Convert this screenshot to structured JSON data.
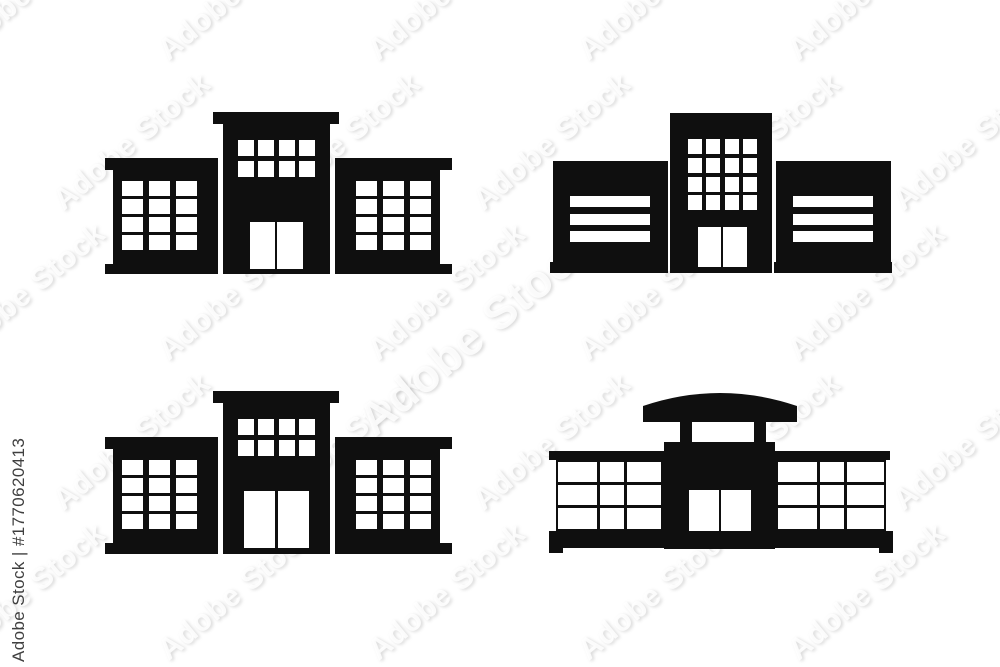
{
  "image": {
    "background": "#ffffff",
    "icon_color": "#0f0f0f",
    "window_color": "#ffffff"
  },
  "watermark": {
    "tile_text": "Adobe Stock",
    "credit": "Adobe Stock | #1770620413"
  },
  "icons": [
    {
      "name": "building-icon-office-grid-windows-top-left"
    },
    {
      "name": "building-icon-office-striped-wings-top-right"
    },
    {
      "name": "building-icon-office-grid-windows-bottom-left"
    },
    {
      "name": "building-icon-mall-curved-roof-bottom-right"
    }
  ]
}
